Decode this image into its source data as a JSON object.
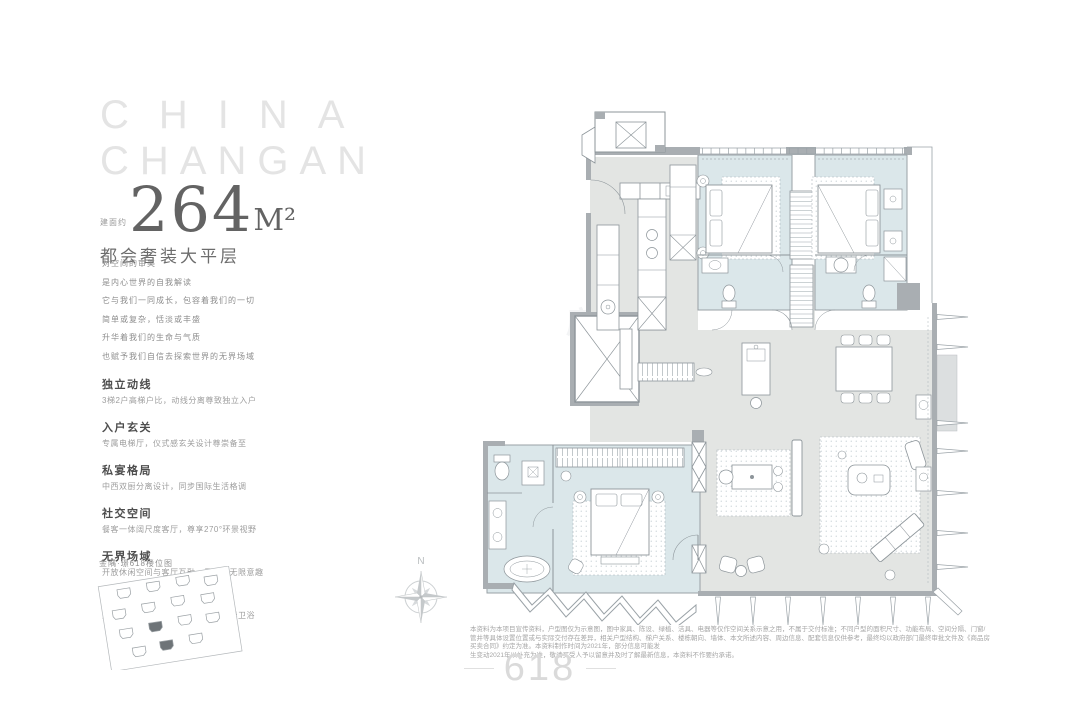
{
  "brand": {
    "line1": "CHINA",
    "line2": "CHANGAN"
  },
  "headline": {
    "prefix": "建面约",
    "area": "264",
    "unit": "M²",
    "subtitle": "都会奢装大平层"
  },
  "intro_lines": [
    "对空间的审美",
    "是内心世界的自我解读",
    "它与我们一同成长，包容着我们的一切",
    "简单或复杂，恬淡或丰盛",
    "升华着我们的生命与气质",
    "也赋予我们自信去探索世界的无界场域"
  ],
  "features": [
    {
      "title": "独立动线",
      "desc": "3梯2户高梯户比，动线分离尊致独立入户"
    },
    {
      "title": "入户玄关",
      "desc": "专属电梯厅，仪式感玄关设计尊崇备至"
    },
    {
      "title": "私宴格局",
      "desc": "中西双厨分离设计，同步国际生活格调"
    },
    {
      "title": "社交空间",
      "desc": "餐客一体阔尺度客厅，尊享270°环景视野"
    },
    {
      "title": "无界场域",
      "desc": "开放休闲空间与客厅互融，予人生无限意趣"
    },
    {
      "title": "主卧系统",
      "desc": "五星级套房主卧设计，南向浴缸奢华卫浴"
    }
  ],
  "site_plan": {
    "caption": "金隅·璟618楼位图"
  },
  "compass": {
    "label": "N"
  },
  "plan_watermark": "房天下",
  "disclaimer": {
    "line1": "本资料为本项目宣传资料，户型图仅为示意图，图中家具、陈设、绿植、洁具、电器等仅作空间关系示意之用，不属于交付标准；不同户型的面积尺寸、功能布局、空间分隔、门窗/管井等具体设置位置或与实际交付存在差异，相关户型结构、梯户关系、楼栋朝向、墙体、本文所述内容、周边信息、配套信息仅供参考，最终均以政府部门最终审批文件及《商品房买卖合同》约定为准。本资料制作时间为2021年，部分信息可能发",
    "line2": "生变动2021年以补充为准，敬请买受人予以留意并及时了解最新信息，本资料不作要约承诺。"
  },
  "logo": {
    "text": "618"
  }
}
